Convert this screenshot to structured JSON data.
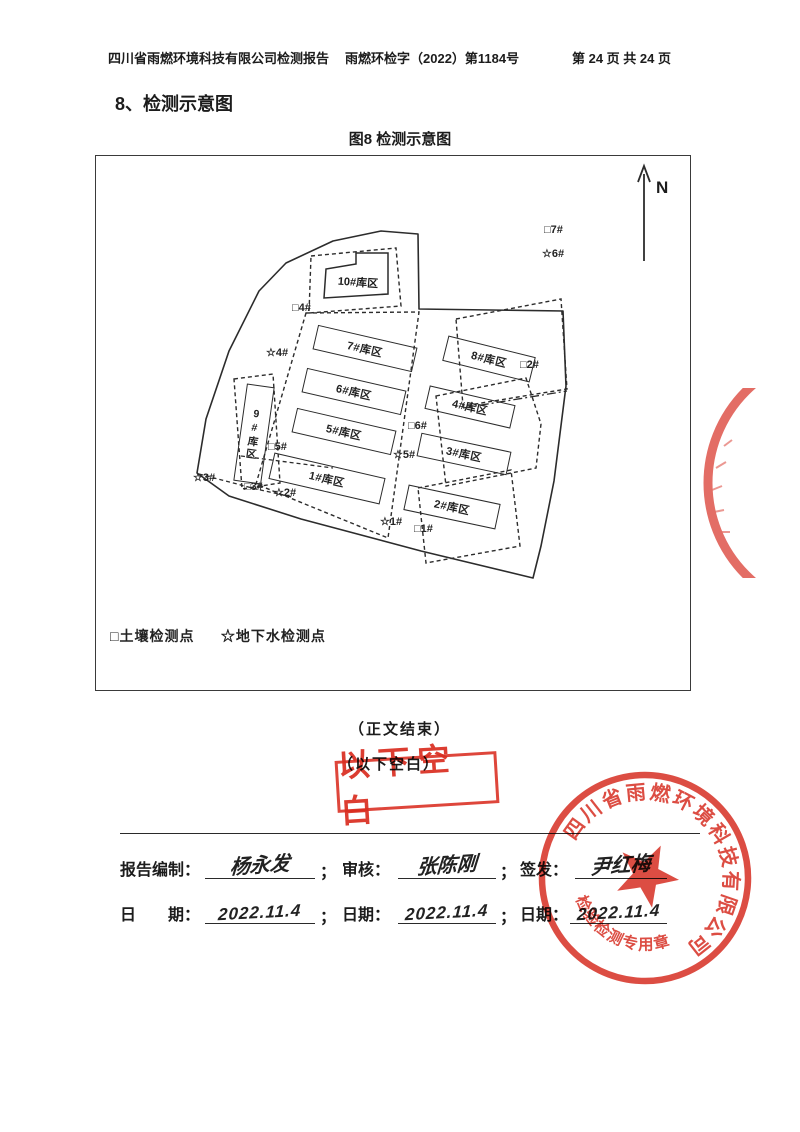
{
  "header": {
    "left": "四川省雨燃环境科技有限公司检测报告",
    "center": "雨燃环检字（2022）第1184号",
    "right": "第 24 页 共 24 页"
  },
  "section_title": "8、检测示意图",
  "figure_caption": "图8 检测示意图",
  "diagram": {
    "north_label": "N",
    "buildings": [
      {
        "label": "10#库区"
      },
      {
        "label": "7#库区"
      },
      {
        "label": "8#库区"
      },
      {
        "label": "6#库区"
      },
      {
        "label": "4#库区"
      },
      {
        "label": "5#库区"
      },
      {
        "label": "3#库区"
      },
      {
        "label": "1#库区"
      },
      {
        "label": "2#库区"
      },
      {
        "label": "9#库区"
      }
    ],
    "points": [
      {
        "text": "□7#"
      },
      {
        "text": "☆6#"
      },
      {
        "text": "□4#"
      },
      {
        "text": "☆4#"
      },
      {
        "text": "□2#"
      },
      {
        "text": "□6#"
      },
      {
        "text": "☆5#"
      },
      {
        "text": "□5#"
      },
      {
        "text": "☆3#"
      },
      {
        "text": "□3#"
      },
      {
        "text": "☆2#"
      },
      {
        "text": "☆1#"
      },
      {
        "text": "□1#"
      }
    ],
    "legend": {
      "soil": "□土壤检测点",
      "groundwater": "☆地下水检测点"
    }
  },
  "body": {
    "end_text": "（正文结束）",
    "blank_text": "（以下空白）",
    "blank_stamp": "以下空白"
  },
  "signatures": {
    "row1": [
      {
        "label": "报告编制：",
        "value": "杨永发",
        "sep": "；"
      },
      {
        "label": "审核：",
        "value": "张陈刚",
        "sep": "；"
      },
      {
        "label": "签发：",
        "value": "尹红梅",
        "sep": ""
      }
    ],
    "row2": [
      {
        "label": "日　　期：",
        "value": "2022.11.4",
        "sep": "；"
      },
      {
        "label": "日期：",
        "value": "2022.11.4",
        "sep": "；"
      },
      {
        "label": "日期：",
        "value": "2022.11.4",
        "sep": ""
      }
    ]
  },
  "seal": {
    "company": "四川省雨燃环境科技有限公司",
    "type_text": "检验检测专用章",
    "color": "#d8352a"
  }
}
